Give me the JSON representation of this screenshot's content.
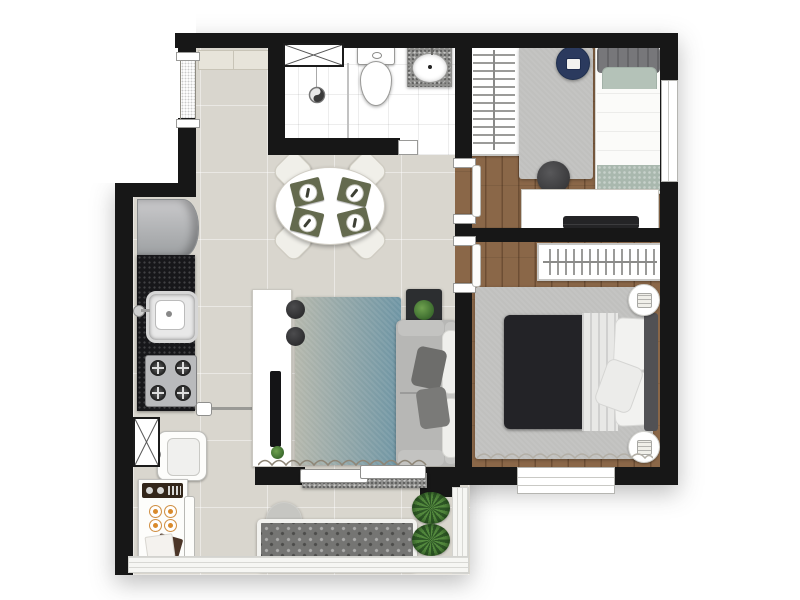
{
  "title": "apartment-floor-plan",
  "colors": {
    "wall": "#171717",
    "tile": "#d9d6ce",
    "bathtile": "#ffffff",
    "wood": "#8a6748",
    "woodseam": "#6d4e34",
    "counter": "#17171a",
    "granite": "#8f8f8d",
    "rug_a": "#b4b7ac",
    "rug_b": "#6e95a4",
    "ruggray": "#c0c0be",
    "sofa": "#b7b7b5",
    "duvet": "#232327",
    "navy": "#2b3a5e",
    "sage": "#b4c2b8",
    "plant": "#548a3e",
    "bench": "#757573",
    "mat": "#646a4e"
  },
  "rooms": [
    {
      "id": "entry",
      "furniture": [
        "entry-door",
        "entry-cabinet"
      ]
    },
    {
      "id": "kitchen",
      "furniture": [
        "refrigerator",
        "black-granite-counter",
        "kitchen-sink",
        "cooktop-4-burners"
      ]
    },
    {
      "id": "service-area",
      "furniture": [
        "duct-shaft",
        "laundry-tank",
        "washing-machine",
        "towels"
      ]
    },
    {
      "id": "bathroom",
      "furniture": [
        "vent-shaft",
        "shower-with-drain",
        "shower-partition",
        "toilet",
        "granite-vanity-with-basin"
      ]
    },
    {
      "id": "dining",
      "furniture": [
        "oval-table",
        "four-chairs",
        "four-place-settings"
      ]
    },
    {
      "id": "living",
      "furniture": [
        "tv-console",
        "tv",
        "two-poufs",
        "gradient-rug",
        "sofa",
        "side-table-with-plant",
        "curtain",
        "sliding-door"
      ]
    },
    {
      "id": "bedroom-1",
      "furniture": [
        "wardrobe-rack",
        "gray-rug",
        "navy-pouf",
        "single-bed",
        "round-pouf",
        "desk-with-laptop",
        "window"
      ]
    },
    {
      "id": "bedroom-2",
      "furniture": [
        "wardrobe-rack",
        "gray-rug",
        "double-bed",
        "two-round-nightstands-with-lamps",
        "curtain",
        "window"
      ]
    },
    {
      "id": "balcony",
      "furniture": [
        "tufted-bench",
        "round-side-table",
        "two-planters",
        "glass-railing"
      ]
    }
  ]
}
